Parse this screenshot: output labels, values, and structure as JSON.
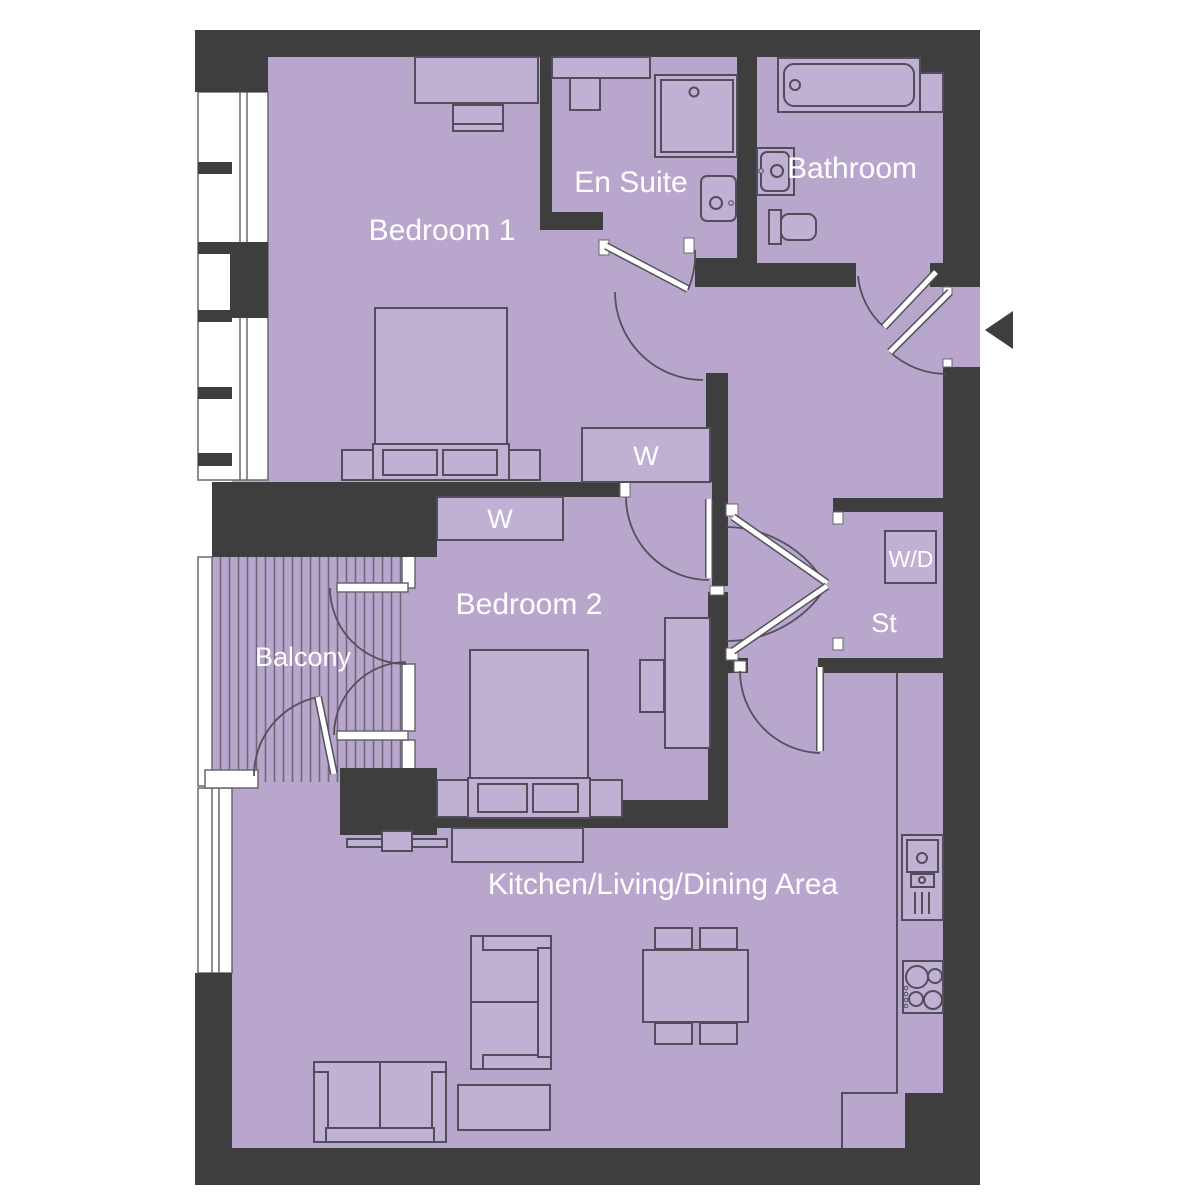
{
  "plan_title": "Two bedroom apartment floor plan",
  "colors": {
    "floor": "#b9a6cd",
    "wall": "#3e3e3e",
    "furniture": "#c0b0d4",
    "outline": "#524d5b",
    "stripe": "#6e6878",
    "window": "#ffffff",
    "label": "#ffffff"
  },
  "rooms": {
    "bedroom1": {
      "label": "Bedroom 1"
    },
    "bedroom2": {
      "label": "Bedroom 2"
    },
    "ensuite": {
      "label": "En Suite"
    },
    "bathroom": {
      "label": "Bathroom"
    },
    "balcony": {
      "label": "Balcony"
    },
    "kitchen_living_dining": {
      "label": "Kitchen/Living/Dining Area"
    },
    "storage": {
      "label": "St"
    }
  },
  "fixtures": {
    "wardrobe_bedroom1": {
      "label": "W"
    },
    "wardrobe_bedroom2": {
      "label": "W"
    },
    "washer_dryer": {
      "label": "W/D"
    }
  },
  "icons": {
    "entry_arrow": "left-pointing-triangle"
  }
}
